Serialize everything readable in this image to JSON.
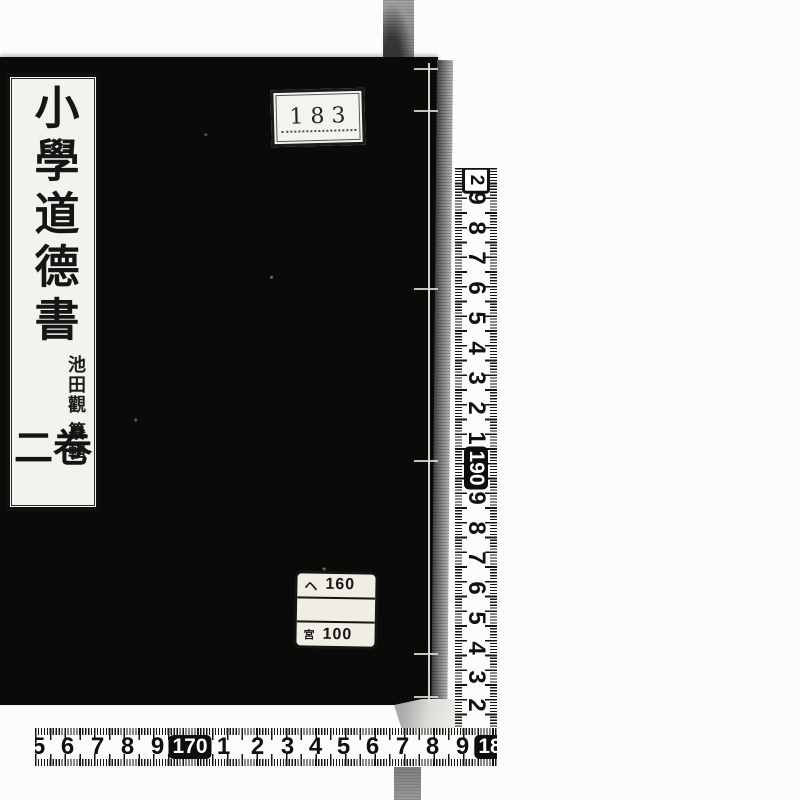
{
  "book": {
    "cover_color": "#0a0a08",
    "title_label": {
      "title": "小學道德書",
      "compiler_name": "池田觀",
      "compiler_role": "纂輯",
      "volume": "卷二"
    },
    "accession_label": {
      "number": "183"
    },
    "call_number_label": {
      "row1_prefix": "ヘ",
      "row1_number": "160",
      "row3_prefix": "宮",
      "row3_number": "100"
    }
  },
  "rulers": {
    "vertical": {
      "unit": "cm",
      "numbers": [
        {
          "t": "2",
          "style": "outlined",
          "y": 12
        },
        {
          "t": "9",
          "y": 30
        },
        {
          "t": "8",
          "y": 60
        },
        {
          "t": "7",
          "y": 90
        },
        {
          "t": "6",
          "y": 120
        },
        {
          "t": "5",
          "y": 150
        },
        {
          "t": "4",
          "y": 180
        },
        {
          "t": "3",
          "y": 210
        },
        {
          "t": "2",
          "y": 240
        },
        {
          "t": "1",
          "y": 270
        },
        {
          "t": "190",
          "style": "boxed",
          "y": 300
        },
        {
          "t": "9",
          "y": 330
        },
        {
          "t": "8",
          "y": 360
        },
        {
          "t": "7",
          "y": 390
        },
        {
          "t": "6",
          "y": 420
        },
        {
          "t": "5",
          "y": 450
        },
        {
          "t": "4",
          "y": 480
        },
        {
          "t": "3",
          "y": 509
        },
        {
          "t": "2",
          "y": 537
        }
      ]
    },
    "horizontal": {
      "unit": "cm",
      "numbers": [
        {
          "t": "5",
          "x": 3
        },
        {
          "t": "6",
          "x": 32
        },
        {
          "t": "7",
          "x": 62
        },
        {
          "t": "8",
          "x": 92
        },
        {
          "t": "9",
          "x": 122
        },
        {
          "t": "170",
          "style": "boxed",
          "x": 155
        },
        {
          "t": "1",
          "x": 188
        },
        {
          "t": "2",
          "x": 222
        },
        {
          "t": "3",
          "x": 252
        },
        {
          "t": "4",
          "x": 280
        },
        {
          "t": "5",
          "x": 308
        },
        {
          "t": "6",
          "x": 337
        },
        {
          "t": "7",
          "x": 367
        },
        {
          "t": "8",
          "x": 397
        },
        {
          "t": "9",
          "x": 427
        },
        {
          "t": "18",
          "style": "boxed",
          "x": 455
        }
      ]
    }
  }
}
